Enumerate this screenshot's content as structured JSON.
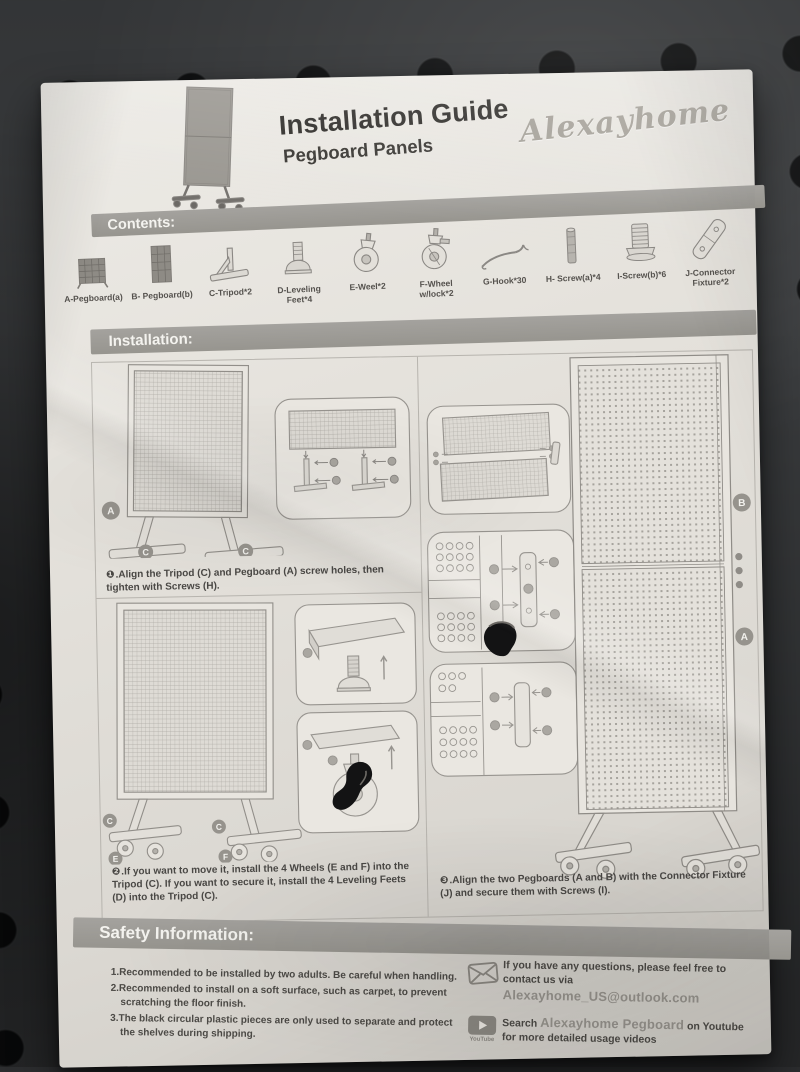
{
  "page": {
    "title": "Installation Guide",
    "subtitle": "Pegboard Panels",
    "brand": "Alexayhome"
  },
  "contents": {
    "header": "Contents:",
    "items": [
      {
        "icon": "pegboard-a-icon",
        "label": "A-Pegboard(a)"
      },
      {
        "icon": "pegboard-b-icon",
        "label": "B- Pegboard(b)"
      },
      {
        "icon": "tripod-icon",
        "label": "C-Tripod*2"
      },
      {
        "icon": "leveling-foot-icon",
        "label": "D-Leveling Feet*4"
      },
      {
        "icon": "wheel-icon",
        "label": "E-Weel*2"
      },
      {
        "icon": "wheel-lock-icon",
        "label": "F-Wheel w/lock*2"
      },
      {
        "icon": "hook-icon",
        "label": "G-Hook*30"
      },
      {
        "icon": "screw-a-icon",
        "label": "H- Screw(a)*4"
      },
      {
        "icon": "screw-b-icon",
        "label": "I-Screw(b)*6"
      },
      {
        "icon": "connector-fixture-icon",
        "label": "J-Connector Fixture*2"
      }
    ]
  },
  "installation": {
    "header": "Installation:",
    "steps": [
      {
        "marker": "❶",
        "text": ".Align the Tripod (C) and Pegboard (A) screw holes, then tighten with Screws (H)."
      },
      {
        "marker": "❷",
        "text": ".If you want to move it, install the 4 Wheels (E and F) into the Tripod (C). If you want to secure it, install the 4 Leveling Feets (D) into the Tripod (C)."
      },
      {
        "marker": "❸",
        "text": ".Align the two Pegboards (A and B) with the Connector Fixture (J) and secure them with Screws (I)."
      }
    ],
    "diagram_labels": {
      "a": "A",
      "b": "B",
      "c": "C",
      "e": "E",
      "f": "F"
    }
  },
  "safety": {
    "header": "Safety Information:",
    "items": [
      "1.Recommended to be installed by two adults. Be careful when handling.",
      "2.Recommended to install on a soft surface, such as carpet, to prevent scratching the floor finish.",
      "3.The black circular plastic pieces are only used to separate and protect the shelves during shipping."
    ]
  },
  "contact": {
    "email_prefix": "If you have any questions, please feel free to contact us via ",
    "email": "Alexayhome_US@outlook.com",
    "youtube_prefix": "Search ",
    "youtube_channel": "Alexayhome Pegboard",
    "youtube_mid": " on Youtube",
    "youtube_suffix": "for more detailed usage videos",
    "youtube_caption": "YouTube"
  },
  "colors": {
    "paper": "#e4e1db",
    "section_bar": "#9b9993",
    "body_text": "#4a4845",
    "muted_text": "#96938d",
    "background_board": "#3a3c3e"
  }
}
